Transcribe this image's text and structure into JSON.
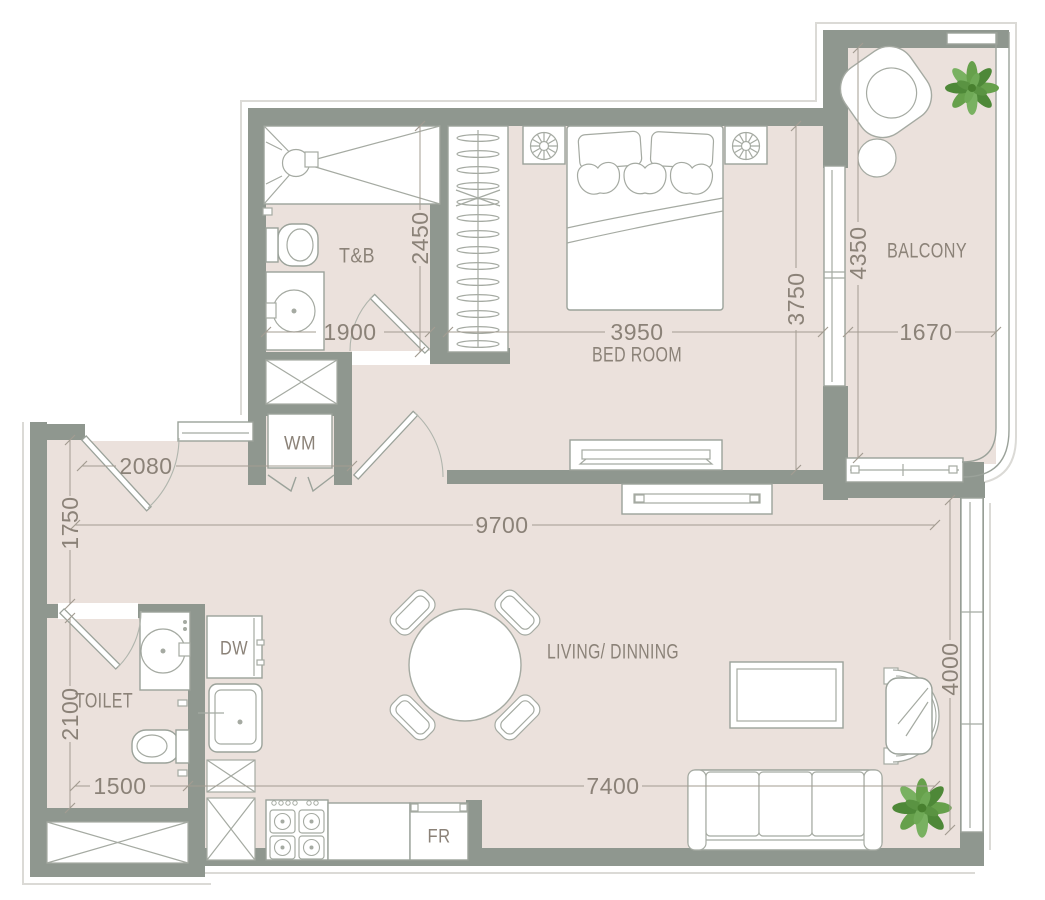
{
  "plan": {
    "title": "One-bedroom apartment floor plan",
    "rooms": {
      "tb": "T&B",
      "bedroom": "BED ROOM",
      "balcony": "BALCONY",
      "toilet": "TOILET",
      "living": "LIVING/ DINNING"
    },
    "appliances": {
      "wm": "WM",
      "dw": "DW",
      "fr": "FR"
    },
    "dimensions": {
      "tb_width": "1900",
      "tb_depth": "2450",
      "bedroom_width": "3950",
      "bedroom_depth": "3750",
      "balcony_depth": "4350",
      "balcony_width": "1670",
      "entry_width": "2080",
      "hall_depth": "1750",
      "living_width": "9700",
      "toilet_depth": "2100",
      "toilet_width": "1500",
      "kitchen_run": "7400",
      "living_depth": "4000"
    },
    "colors": {
      "floor": "#ebe1dc",
      "wall": "#8f978f",
      "fixture_line": "#9ba29a",
      "dimension_text": "#8b8278",
      "plant_green": "#66a04b"
    }
  }
}
